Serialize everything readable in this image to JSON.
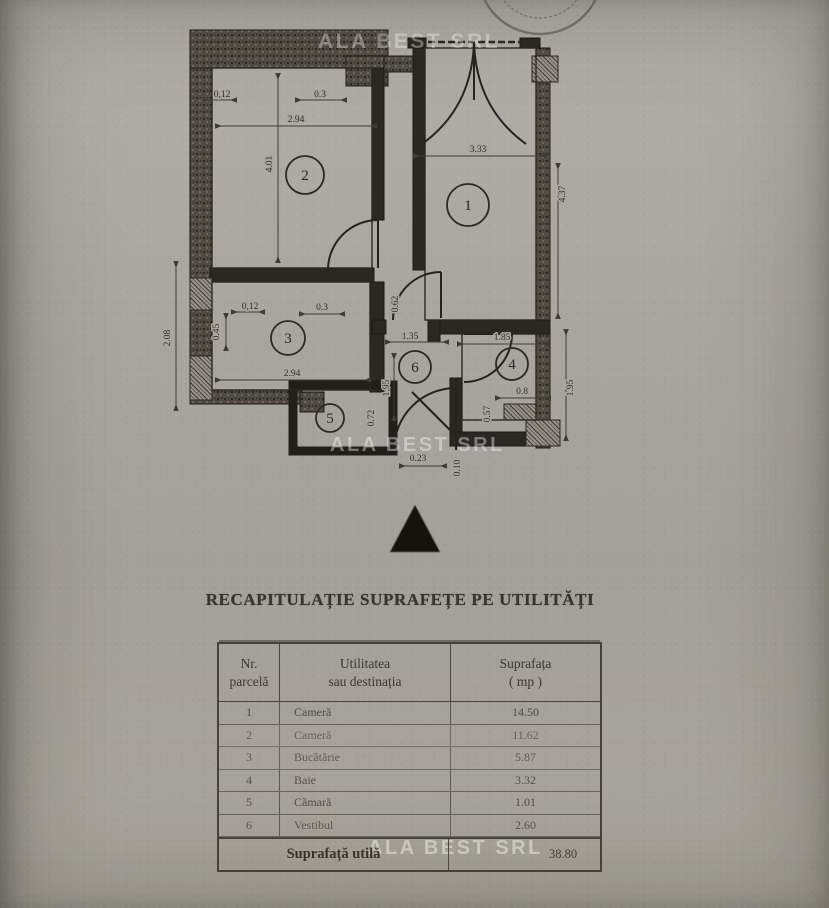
{
  "watermark": {
    "text": "ALA BEST SRL"
  },
  "stamp": {
    "text": "· A ·"
  },
  "plan": {
    "rooms": {
      "r1": "1",
      "r2": "2",
      "r3": "3",
      "r4": "4",
      "r5": "5",
      "r6": "6"
    },
    "dims": {
      "top_012": "0,12",
      "top_03": "0.3",
      "room2_width": "2.94",
      "room2_height": "4.01",
      "room1_width": "3.33",
      "room1_height": "4.37",
      "left_height": "2.08",
      "kitchen_012": "0,12",
      "kitchen_03": "0.3",
      "kitchen_045": "0.45",
      "duct_062": "0.62",
      "kitchen_width": "2.94",
      "hall_width": "1.35",
      "hall_height": "1.95",
      "bath_width": "1.85",
      "bath_08": "0.8",
      "bath_057": "0.57",
      "right_195": "1.95",
      "pantry_072": "0.72",
      "entry_023": "0.23",
      "entry_010": "0.10"
    }
  },
  "section": {
    "title": "RECAPITULAȚIE SUPRAFEȚE PE UTILITĂȚI"
  },
  "table": {
    "header": {
      "col1_line1": "Nr.",
      "col1_line2": "parcelă",
      "col2_line1": "Utilitatea",
      "col2_line2": "sau destinația",
      "col3_line1": "Suprafața",
      "col3_line2": "( mp )"
    },
    "rows": [
      {
        "nr": "1",
        "name": "Cameră",
        "area": "14.50"
      },
      {
        "nr": "2",
        "name": "Cameră",
        "area": "11.62"
      },
      {
        "nr": "3",
        "name": "Bucătărie",
        "area": "5.87"
      },
      {
        "nr": "4",
        "name": "Baie",
        "area": "3.32"
      },
      {
        "nr": "5",
        "name": "Cămară",
        "area": "1.01"
      },
      {
        "nr": "6",
        "name": "Vestibul",
        "area": "2.60"
      }
    ],
    "footer": {
      "label": "Suprafață utilă",
      "value": "38.80"
    }
  }
}
